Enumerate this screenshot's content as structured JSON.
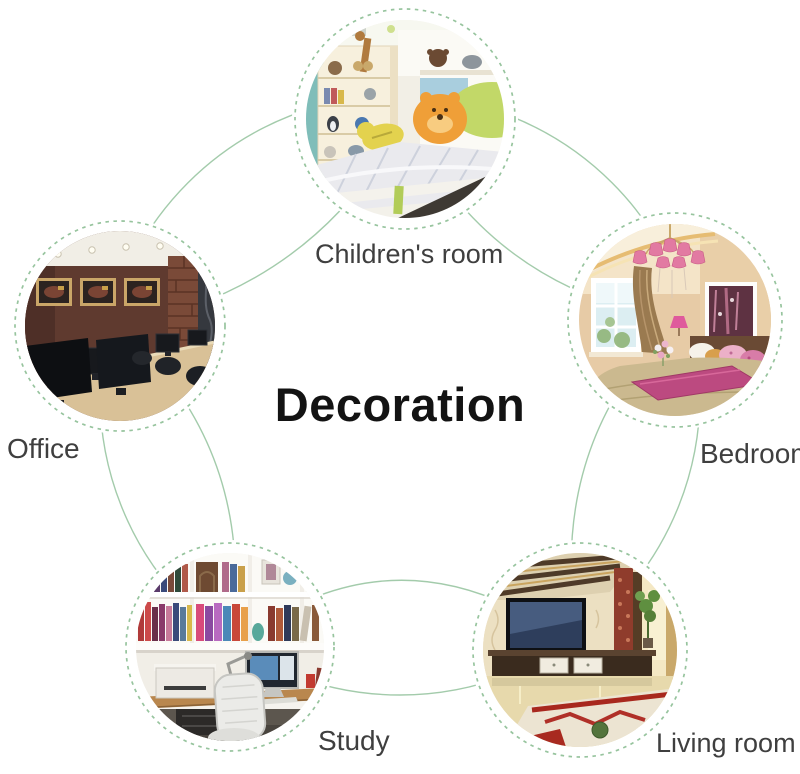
{
  "title": "Decoration",
  "nodes": [
    {
      "id": "childrens-room",
      "label": "Children's room"
    },
    {
      "id": "office",
      "label": "Office"
    },
    {
      "id": "bedroom",
      "label": "Bedroom"
    },
    {
      "id": "study",
      "label": "Study"
    },
    {
      "id": "living-room",
      "label": "Living room"
    }
  ],
  "colors": {
    "ring_line": "#8dbf97",
    "dashed_border": "#97c49e",
    "label_text": "#3f3f3f",
    "title_text": "#131313",
    "background": "#ffffff"
  }
}
